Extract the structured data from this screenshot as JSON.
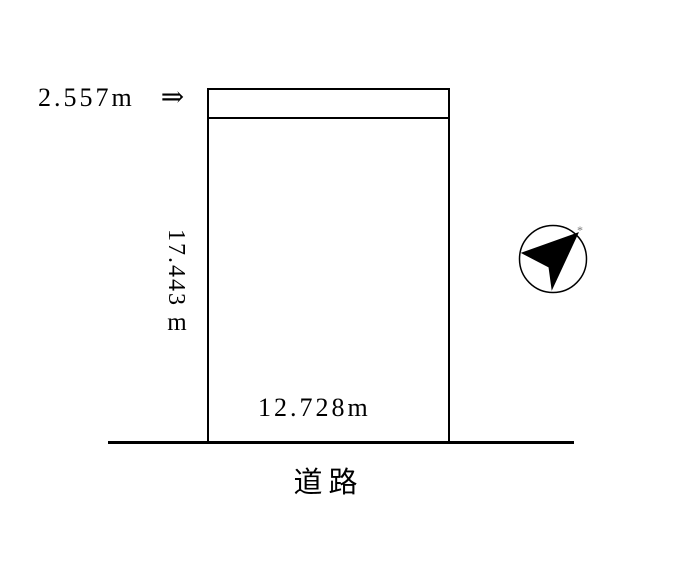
{
  "page": {
    "background_color": "#ffffff",
    "line_color": "#000000"
  },
  "plot": {
    "setback_dimension": {
      "value": "2.557m",
      "arrow_glyph": "⇒"
    },
    "depth_dimension": {
      "value": "17.443",
      "unit": "m"
    },
    "frontage_dimension": {
      "value": "12.728m"
    }
  },
  "road": {
    "label": "道路"
  },
  "compass": {
    "icon": "north-arrow-icon",
    "mark_glyph": "*"
  }
}
